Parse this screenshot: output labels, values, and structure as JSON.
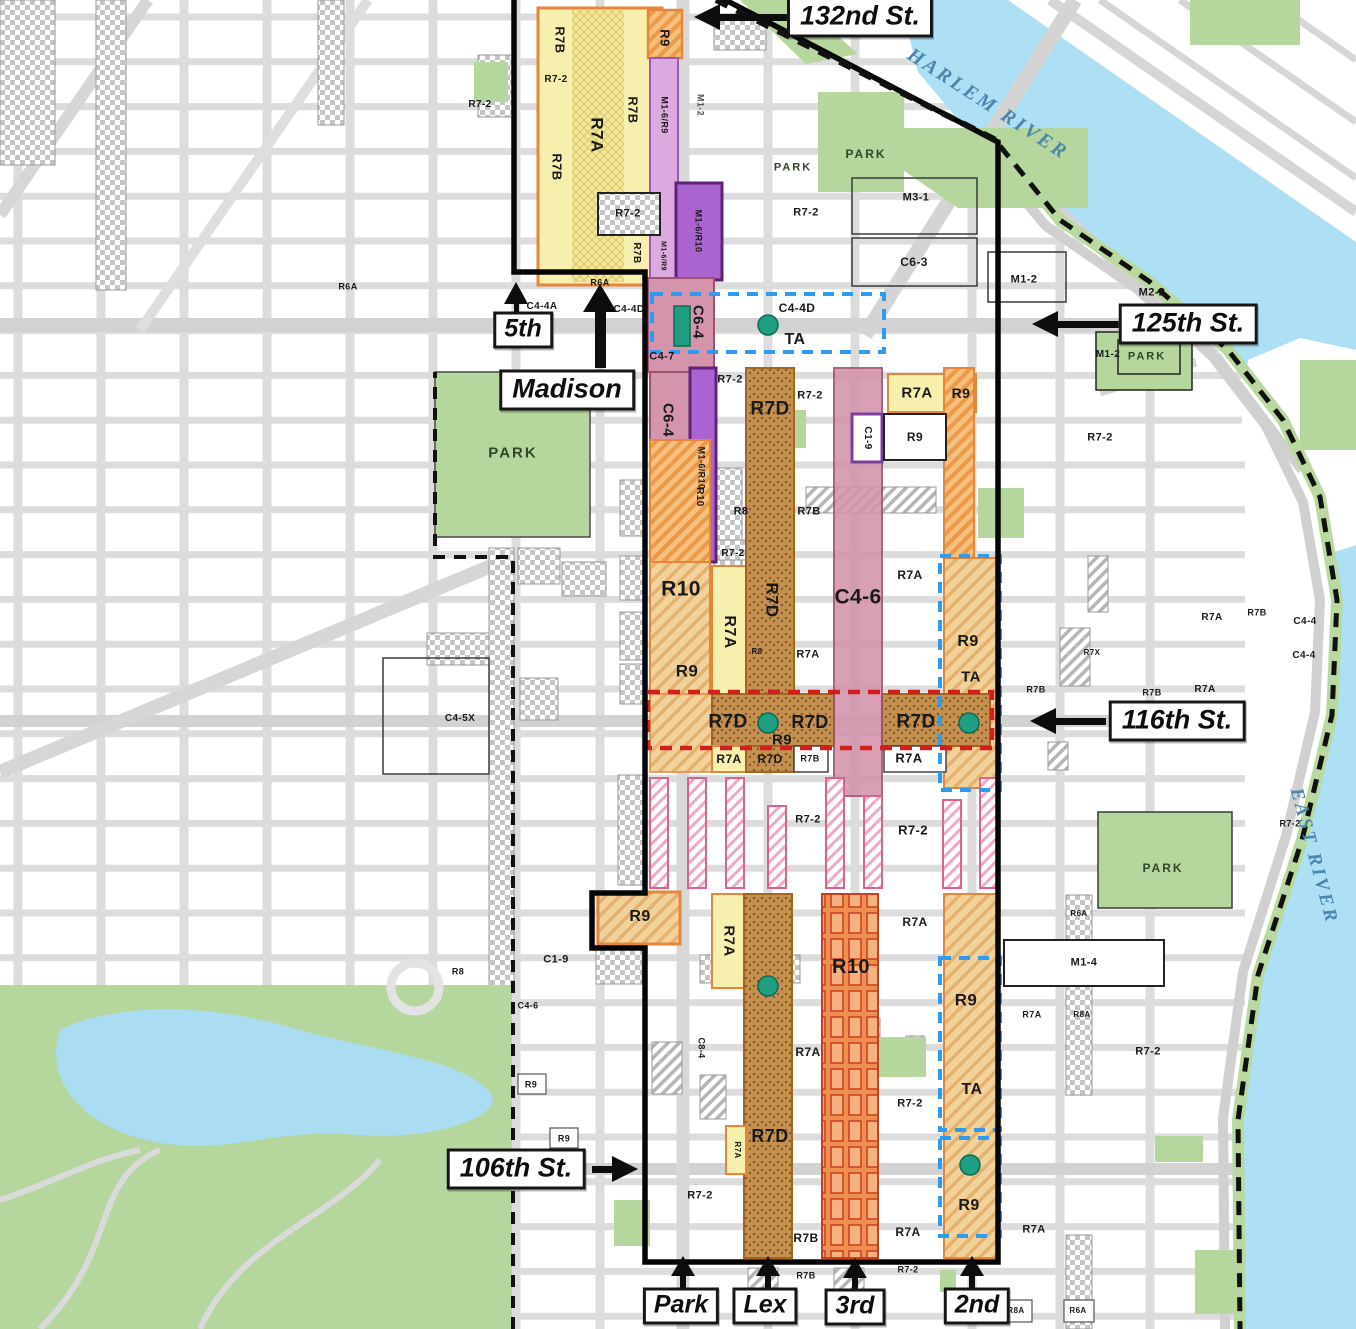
{
  "map": {
    "title": "East Harlem zoning map",
    "rivers": [
      "HARLEM RIVER",
      "EAST RIVER"
    ],
    "colors": {
      "water": "#aee0f5",
      "park_green": "#b5d69c",
      "street_gray": "#dcdcdc",
      "zone_yellow": "#f6efad",
      "zone_orange": "#ec9a47",
      "zone_brown": "#c49050",
      "zone_pink": "#d494ab",
      "zone_purple": "#ab63cf",
      "zone_lilac": "#dcaade",
      "boundary_black": "#060606",
      "dashed_blue": "#2e9bf0",
      "dashed_red": "#cf1f1f",
      "dot_teal": "#1f9e82"
    },
    "street_signs": [
      {
        "id": "132nd-st",
        "t": "132nd St.",
        "x": 860,
        "y": 17,
        "arrow": "left"
      },
      {
        "id": "125th-st",
        "t": "125th St.",
        "x": 1188,
        "y": 324,
        "arrow": "left"
      },
      {
        "id": "116th-st",
        "t": "116th St.",
        "x": 1177,
        "y": 721,
        "arrow": "left"
      },
      {
        "id": "106th-st",
        "t": "106th St.",
        "x": 516,
        "y": 1169,
        "arrow": "right"
      },
      {
        "id": "5th-ave",
        "t": "5th",
        "x": 523,
        "y": 330,
        "arrow": "up",
        "small": true
      },
      {
        "id": "madison-ave",
        "t": "Madison",
        "x": 567,
        "y": 390,
        "arrow": "up"
      },
      {
        "id": "park-ave",
        "t": "Park",
        "x": 681,
        "y": 1306,
        "arrow": "up",
        "small": true
      },
      {
        "id": "lex-ave",
        "t": "Lex",
        "x": 765,
        "y": 1306,
        "arrow": "up",
        "small": true
      },
      {
        "id": "3rd-ave",
        "t": "3rd",
        "x": 855,
        "y": 1307,
        "arrow": "up",
        "small": true
      },
      {
        "id": "2nd-ave",
        "t": "2nd",
        "x": 977,
        "y": 1306,
        "arrow": "up",
        "small": true
      }
    ],
    "zone_labels": [
      {
        "t": "R7B",
        "x": 560,
        "y": 40,
        "s": 13,
        "r": 90
      },
      {
        "t": "R7-2",
        "x": 556,
        "y": 80,
        "s": 10
      },
      {
        "t": "R7-2",
        "x": 480,
        "y": 105,
        "s": 10
      },
      {
        "t": "R7B",
        "x": 633,
        "y": 110,
        "s": 13,
        "r": 90
      },
      {
        "t": "R7A",
        "x": 597,
        "y": 135,
        "s": 17,
        "r": 90
      },
      {
        "t": "R7B",
        "x": 557,
        "y": 167,
        "s": 13,
        "r": 90
      },
      {
        "t": "R9",
        "x": 665,
        "y": 38,
        "s": 13,
        "r": 90
      },
      {
        "t": "M1-6/R9",
        "x": 664,
        "y": 115,
        "s": 9,
        "r": 90
      },
      {
        "t": "M1-2",
        "x": 700,
        "y": 105,
        "s": 9,
        "r": 90,
        "c": "dim"
      },
      {
        "t": "R7-2",
        "x": 628,
        "y": 214,
        "s": 11
      },
      {
        "t": "M1-6/R10",
        "x": 698,
        "y": 231,
        "s": 9,
        "r": 90
      },
      {
        "t": "R7B",
        "x": 636,
        "y": 253,
        "s": 10,
        "r": 90
      },
      {
        "t": "M1-6/R9",
        "x": 663,
        "y": 256,
        "s": 7,
        "r": 90
      },
      {
        "t": "R6A",
        "x": 348,
        "y": 287,
        "s": 9
      },
      {
        "t": "R6A",
        "x": 600,
        "y": 283,
        "s": 9
      },
      {
        "t": "C4-4A",
        "x": 542,
        "y": 307,
        "s": 10
      },
      {
        "t": "C4-4D",
        "x": 629,
        "y": 310,
        "s": 10
      },
      {
        "t": "C6-4",
        "x": 698,
        "y": 322,
        "s": 15,
        "r": 90
      },
      {
        "t": "C4-7",
        "x": 662,
        "y": 357,
        "s": 11
      },
      {
        "t": "C4-4D",
        "x": 797,
        "y": 308,
        "s": 12
      },
      {
        "t": "TA",
        "x": 795,
        "y": 340,
        "s": 16
      },
      {
        "t": "M3-1",
        "x": 916,
        "y": 198,
        "s": 11
      },
      {
        "t": "R7-2",
        "x": 806,
        "y": 213,
        "s": 11
      },
      {
        "t": "C6-3",
        "x": 914,
        "y": 262,
        "s": 12
      },
      {
        "t": "M1-2",
        "x": 1024,
        "y": 280,
        "s": 11
      },
      {
        "t": "M2-2",
        "x": 1152,
        "y": 293,
        "s": 11
      },
      {
        "t": "M1-2",
        "x": 1108,
        "y": 355,
        "s": 10
      },
      {
        "t": "R7-2",
        "x": 1100,
        "y": 438,
        "s": 11
      },
      {
        "t": "C6-4",
        "x": 668,
        "y": 420,
        "s": 15,
        "r": 90
      },
      {
        "t": "M1-6/R10",
        "x": 701,
        "y": 468,
        "s": 9,
        "r": 90
      },
      {
        "t": "R7-2",
        "x": 730,
        "y": 380,
        "s": 11
      },
      {
        "t": "R7-2",
        "x": 810,
        "y": 396,
        "s": 11
      },
      {
        "t": "R7D",
        "x": 770,
        "y": 409,
        "s": 19
      },
      {
        "t": "R7A",
        "x": 917,
        "y": 393,
        "s": 15
      },
      {
        "t": "R9",
        "x": 961,
        "y": 393,
        "s": 14
      },
      {
        "t": "C1-9",
        "x": 867,
        "y": 438,
        "s": 10,
        "r": 90
      },
      {
        "t": "R9",
        "x": 915,
        "y": 437,
        "s": 12
      },
      {
        "t": "R10",
        "x": 699,
        "y": 497,
        "s": 10,
        "r": 90
      },
      {
        "t": "R8",
        "x": 741,
        "y": 512,
        "s": 11
      },
      {
        "t": "R7B",
        "x": 809,
        "y": 512,
        "s": 11
      },
      {
        "t": "R7-2",
        "x": 733,
        "y": 554,
        "s": 10
      },
      {
        "t": "R10",
        "x": 681,
        "y": 589,
        "s": 21
      },
      {
        "t": "R7A",
        "x": 729,
        "y": 632,
        "s": 16,
        "r": 90
      },
      {
        "t": "R8",
        "x": 757,
        "y": 652,
        "s": 8
      },
      {
        "t": "R7D",
        "x": 772,
        "y": 600,
        "s": 17,
        "r": 90
      },
      {
        "t": "C4-6",
        "x": 858,
        "y": 597,
        "s": 21
      },
      {
        "t": "R7A",
        "x": 910,
        "y": 575,
        "s": 12
      },
      {
        "t": "R7A",
        "x": 808,
        "y": 655,
        "s": 11
      },
      {
        "t": "R9",
        "x": 687,
        "y": 671,
        "s": 17
      },
      {
        "t": "R9",
        "x": 968,
        "y": 642,
        "s": 16
      },
      {
        "t": "TA",
        "x": 971,
        "y": 677,
        "s": 15
      },
      {
        "t": "R7X",
        "x": 1092,
        "y": 653,
        "s": 8
      },
      {
        "t": "R7B",
        "x": 1036,
        "y": 690,
        "s": 9
      },
      {
        "t": "R7A",
        "x": 1205,
        "y": 690,
        "s": 10
      },
      {
        "t": "R7B",
        "x": 1152,
        "y": 693,
        "s": 9
      },
      {
        "t": "R7A",
        "x": 1212,
        "y": 618,
        "s": 10
      },
      {
        "t": "R7B",
        "x": 1257,
        "y": 613,
        "s": 9
      },
      {
        "t": "C4-4",
        "x": 1305,
        "y": 622,
        "s": 10
      },
      {
        "t": "C4-4",
        "x": 1304,
        "y": 656,
        "s": 10
      },
      {
        "t": "R7-2",
        "x": 1290,
        "y": 824,
        "s": 9
      },
      {
        "t": "C4-5X",
        "x": 460,
        "y": 719,
        "s": 10
      },
      {
        "t": "R7D",
        "x": 728,
        "y": 722,
        "s": 19
      },
      {
        "t": "R9",
        "x": 782,
        "y": 740,
        "s": 15
      },
      {
        "t": "R7D",
        "x": 810,
        "y": 722,
        "s": 18
      },
      {
        "t": "R7D",
        "x": 916,
        "y": 722,
        "s": 19
      },
      {
        "t": "R7A",
        "x": 729,
        "y": 759,
        "s": 12
      },
      {
        "t": "R7D",
        "x": 770,
        "y": 759,
        "s": 12
      },
      {
        "t": "R7B",
        "x": 810,
        "y": 759,
        "s": 9
      },
      {
        "t": "R7A",
        "x": 909,
        "y": 758,
        "s": 13
      },
      {
        "t": "R7-2",
        "x": 808,
        "y": 820,
        "s": 11
      },
      {
        "t": "R7-2",
        "x": 913,
        "y": 830,
        "s": 13
      },
      {
        "t": "R9",
        "x": 640,
        "y": 917,
        "s": 16
      },
      {
        "t": "R7A",
        "x": 915,
        "y": 922,
        "s": 12
      },
      {
        "t": "R7A",
        "x": 729,
        "y": 941,
        "s": 15,
        "r": 90
      },
      {
        "t": "R10",
        "x": 851,
        "y": 967,
        "s": 20
      },
      {
        "t": "R8",
        "x": 458,
        "y": 972,
        "s": 9
      },
      {
        "t": "C1-9",
        "x": 556,
        "y": 960,
        "s": 11
      },
      {
        "t": "C4-6",
        "x": 528,
        "y": 1006,
        "s": 9
      },
      {
        "t": "R9",
        "x": 531,
        "y": 1085,
        "s": 9
      },
      {
        "t": "R9",
        "x": 564,
        "y": 1139,
        "s": 9
      },
      {
        "t": "C8-4",
        "x": 701,
        "y": 1048,
        "s": 9,
        "r": 90
      },
      {
        "t": "R7A",
        "x": 808,
        "y": 1052,
        "s": 12
      },
      {
        "t": "R9",
        "x": 966,
        "y": 1000,
        "s": 17
      },
      {
        "t": "R6A",
        "x": 1079,
        "y": 914,
        "s": 8
      },
      {
        "t": "M1-4",
        "x": 1084,
        "y": 963,
        "s": 11
      },
      {
        "t": "R7A",
        "x": 1032,
        "y": 1015,
        "s": 9
      },
      {
        "t": "R8A",
        "x": 1082,
        "y": 1015,
        "s": 8
      },
      {
        "t": "R7-2",
        "x": 1148,
        "y": 1052,
        "s": 11
      },
      {
        "t": "TA",
        "x": 972,
        "y": 1090,
        "s": 16
      },
      {
        "t": "R7-2",
        "x": 910,
        "y": 1104,
        "s": 11
      },
      {
        "t": "R7D",
        "x": 770,
        "y": 1136,
        "s": 18
      },
      {
        "t": "R7A",
        "x": 737,
        "y": 1150,
        "s": 8,
        "r": 90
      },
      {
        "t": "R7-2",
        "x": 700,
        "y": 1196,
        "s": 11
      },
      {
        "t": "R7A",
        "x": 908,
        "y": 1232,
        "s": 12
      },
      {
        "t": "R7B",
        "x": 806,
        "y": 1238,
        "s": 12
      },
      {
        "t": "R9",
        "x": 969,
        "y": 1206,
        "s": 16
      },
      {
        "t": "R7A",
        "x": 1034,
        "y": 1230,
        "s": 11
      },
      {
        "t": "R7-2",
        "x": 908,
        "y": 1270,
        "s": 9
      },
      {
        "t": "R7B",
        "x": 806,
        "y": 1276,
        "s": 9
      },
      {
        "t": "R8A",
        "x": 1016,
        "y": 1311,
        "s": 8
      },
      {
        "t": "R6A",
        "x": 1078,
        "y": 1311,
        "s": 8
      },
      {
        "t": "PARK",
        "x": 793,
        "y": 168,
        "s": 11,
        "c": "park"
      },
      {
        "t": "PARK",
        "x": 866,
        "y": 154,
        "s": 12,
        "c": "park"
      },
      {
        "t": "PARK",
        "x": 1147,
        "y": 357,
        "s": 11,
        "c": "park"
      },
      {
        "t": "PARK",
        "x": 513,
        "y": 453,
        "s": 15,
        "c": "park"
      },
      {
        "t": "PARK",
        "x": 1163,
        "y": 868,
        "s": 12,
        "c": "park"
      },
      {
        "t": "HARLEM RIVER",
        "x": 988,
        "y": 104,
        "s": 20,
        "r": 33,
        "c": "river"
      },
      {
        "t": "EAST RIVER",
        "x": 1314,
        "y": 856,
        "s": 19,
        "r": 75,
        "c": "river"
      }
    ]
  }
}
